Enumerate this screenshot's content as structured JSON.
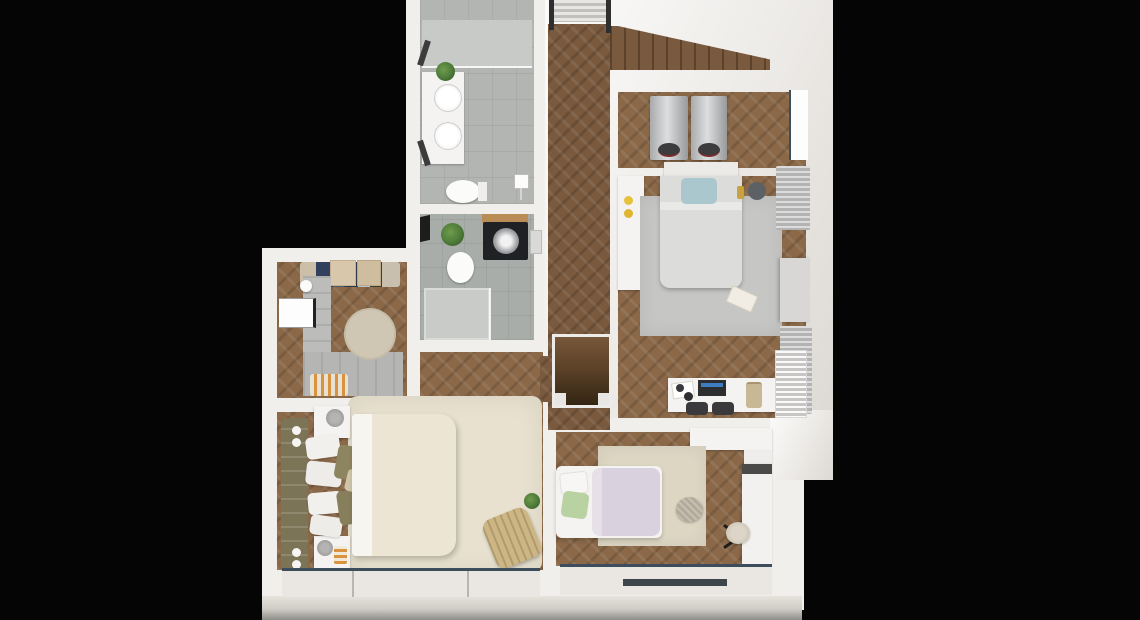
{
  "scene": {
    "type": "3d-floor-plan-render",
    "view": "top-down dollhouse cutaway",
    "background": "black",
    "floor_material": "herringbone oak parquet",
    "rooms": [
      {
        "id": "bathroom",
        "label": "Bathroom",
        "furniture": [
          "walk-in shower with glass panel",
          "double-sink vanity",
          "wall mirrors",
          "toilet",
          "potted plant",
          "light switch"
        ]
      },
      {
        "id": "wc",
        "label": "WC / utility room",
        "furniture": [
          "toilet",
          "black washing machine",
          "wooden shelf",
          "shower tray",
          "hand basin",
          "potted plant",
          "slit window"
        ]
      },
      {
        "id": "hallway",
        "label": "Hallway",
        "furniture": [
          "entry door with dark posts",
          "striped landing mat",
          "wooden staircase going up",
          "dark stairwell going down"
        ]
      },
      {
        "id": "storage-nook",
        "label": "Storage / laundry nook",
        "furniture": [
          "two silver appliances",
          "window"
        ]
      },
      {
        "id": "bedroom-top-right",
        "label": "Bedroom (top right)",
        "furniture": [
          "double bed",
          "blue accent pillow",
          "gray area rug",
          "white wall shelf with yellow decor",
          "dark pouf",
          "book on rug",
          "desk with laptop",
          "two dark stools",
          "hanging bag",
          "pleated curtains",
          "TV panel",
          "radiator",
          "windows"
        ]
      },
      {
        "id": "walk-in-closet",
        "label": "Walk-in closet",
        "furniture": [
          "hanging clothes",
          "storage boxes",
          "L-shaped gray wardrobe",
          "round beige rug",
          "orange striped bench",
          "window"
        ]
      },
      {
        "id": "bedroom-bottom-left",
        "label": "Main bedroom (bottom left)",
        "furniture": [
          "olive tufted headboard",
          "double bed with cream duvet",
          "white and olive pillows",
          "two white nightstands",
          "gray table lamps",
          "striped candle",
          "round wall sconces",
          "cream shag rug",
          "wicker chair",
          "potted plant",
          "panoramic bottom window"
        ]
      },
      {
        "id": "bedroom-kids",
        "label": "Kids bedroom (bottom middle)",
        "furniture": [
          "single bed with lavender duvet",
          "green pillow",
          "white pillow",
          "beige square rug",
          "knitted pouf",
          "white desk with dark edge",
          "chair with black legs",
          "white wardrobe cabinet",
          "bottom window with dark track"
        ]
      }
    ]
  },
  "palette": {
    "bg": "#050505",
    "wall": "#f0efec",
    "wood": "#8a6848",
    "wood-dark": "#7a5a3e",
    "tile": "#b2b5b2",
    "shower": "#c8cac8",
    "rug-cream": "#e8e1cf",
    "rug-gray": "#c6c6c4",
    "rug-beige": "#ddd6c3",
    "rug-round": "#cfc7b3",
    "duvet-cream": "#ece5d3",
    "duvet-gray": "#dcdcda",
    "duvet-lavender": "#d9d1de",
    "pillow-olive": "#8d8460",
    "pillow-blue": "#aac7ce",
    "pillow-green": "#b9d2a2",
    "headboard-olive": "#7c7456",
    "appliance-silver": "#c3c5c7",
    "washer-black": "#202124",
    "plant": "#4d7a39",
    "wood-shelf": "#b98d55",
    "chair-tan": "#cdb683",
    "accent-orange": "#d9933f",
    "glass-frame": "#3c4d5c",
    "sill": "#eae7e2"
  }
}
